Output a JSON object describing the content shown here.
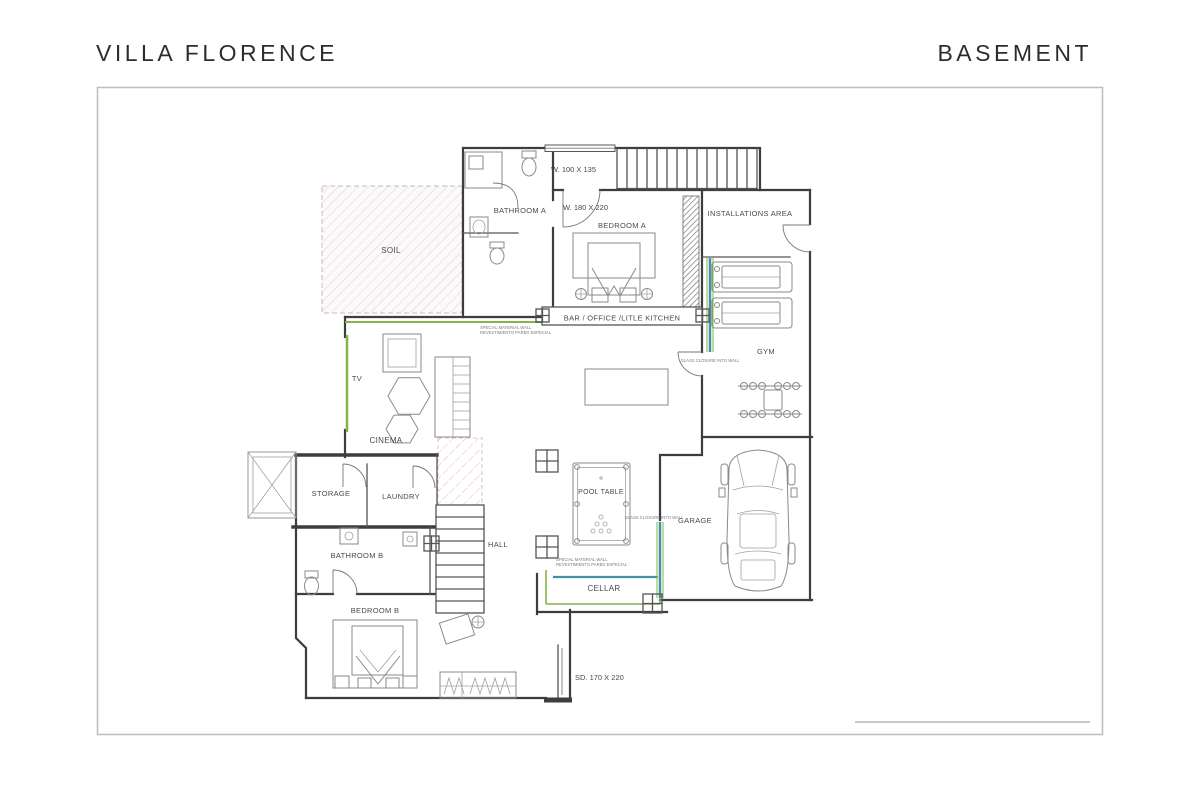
{
  "header": {
    "project": "VILLA FLORENCE",
    "sheet": "BASEMENT"
  },
  "rooms": {
    "soil": "SOIL",
    "bathroom_a": "BATHROOM A",
    "bedroom_a": "BEDROOM A",
    "installations_area": "INSTALLATIONS AREA",
    "gym": "GYM",
    "bar_office_kitchen": "BAR / OFFICE /LITLE KITCHEN",
    "tv": "TV",
    "cinema": "CINEMA",
    "pool_table": "POOL TABLE",
    "garage": "GARAGE",
    "storage": "STORAGE",
    "laundry": "LAUNDRY",
    "bathroom_b": "BATHROOM B",
    "hall": "HALL",
    "bedroom_b": "BEDROOM B",
    "cellar": "CELLAR"
  },
  "dimensions": {
    "window_a": "W. 100 X 135",
    "door_a": "W. 180 X 220",
    "sliding_door": "SD. 170 X 220"
  },
  "annotations": {
    "special_wall_l1": "SPECIAL MATERIAL WALL",
    "special_wall_l2": "REVESTIMIENTO PARED ESPECIAL",
    "glass_closure": "GLASS CLOSURE INTO WALL"
  },
  "colors": {
    "wall": "#3d3d3d",
    "accent_green": "#86b34a",
    "accent_teal": "#3f93a3",
    "hatch_pink": "#e4b6cb",
    "frame_gray": "#bdbdbd",
    "text": "#4a4a4a"
  }
}
